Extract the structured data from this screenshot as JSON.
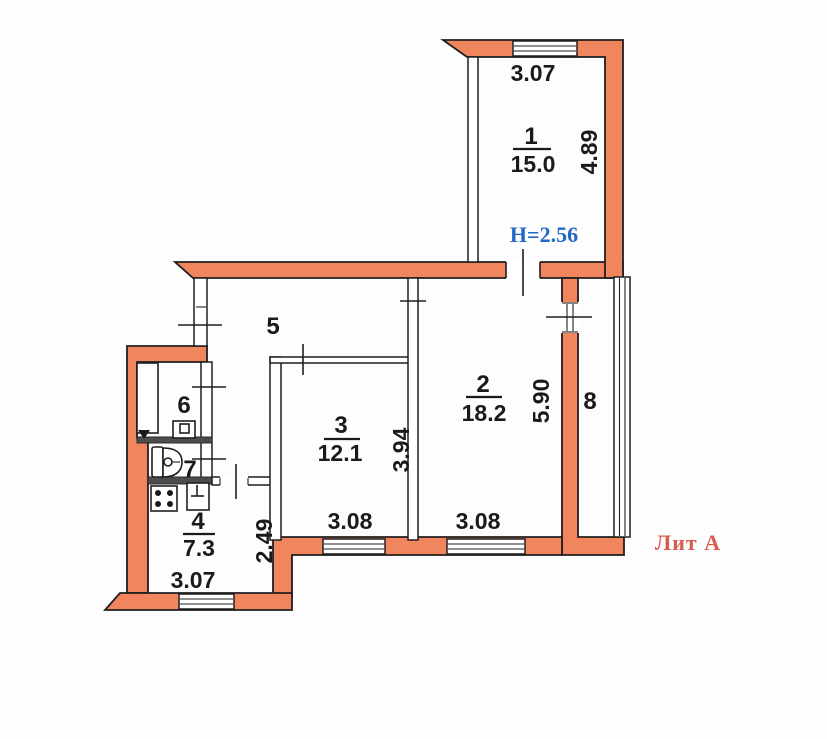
{
  "rooms": [
    {
      "number": "1",
      "area": "15.0"
    },
    {
      "number": "2",
      "area": "18.2"
    },
    {
      "number": "3",
      "area": "12.1"
    },
    {
      "number": "4",
      "area": "7.3"
    },
    {
      "number": "5"
    },
    {
      "number": "6"
    },
    {
      "number": "7"
    },
    {
      "number": "8"
    }
  ],
  "dimensions": {
    "room1_width": "3.07",
    "room1_depth": "4.89",
    "room2_width": "3.08",
    "room2_depth": "5.90",
    "room3_width": "3.08",
    "room3_depth": "3.94",
    "room4_width": "3.07",
    "room4_depth": "2.49"
  },
  "annotations": {
    "ceiling_height": "H=2.56",
    "litera": "Лит А"
  },
  "colors": {
    "wall": "#f0855e",
    "line": "#1f1f1f",
    "ceiling_height_text": "#2368c4",
    "litera_text": "#d85c4e"
  }
}
